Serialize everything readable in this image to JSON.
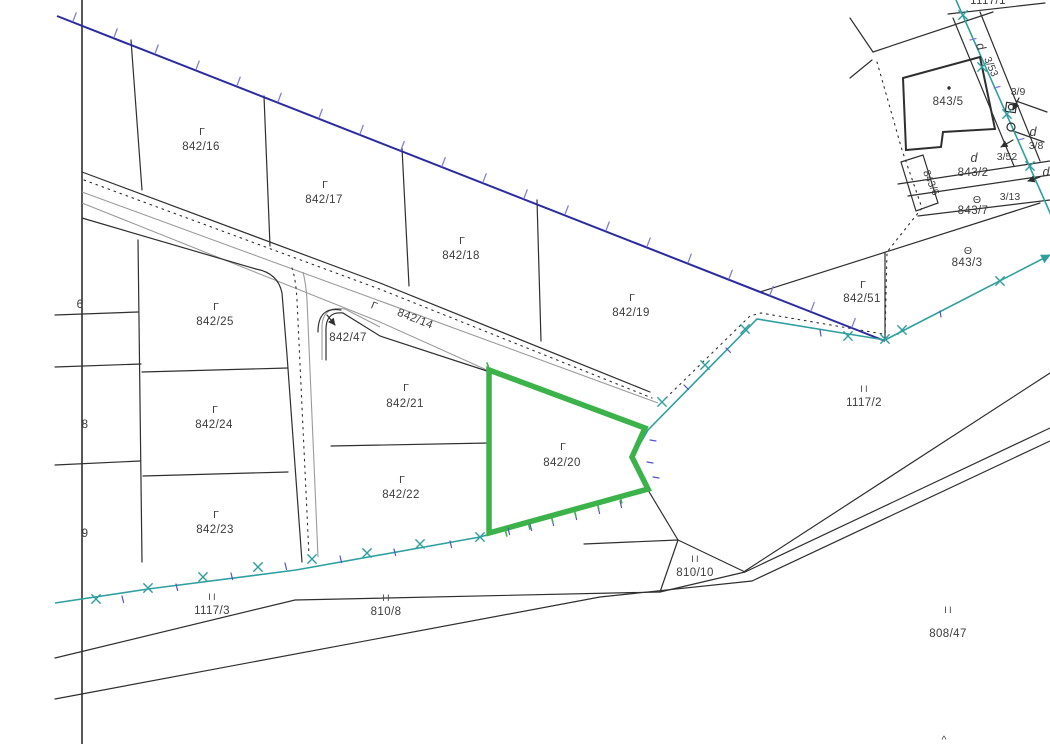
{
  "title": "cadastral-map-view",
  "highlight": {
    "parcel": "842/20",
    "color": "#3cb24b"
  },
  "colors": {
    "blue_boundary": "#2b2ba0",
    "tick_light_blue": "#8080d8",
    "teal_boundary": "#2f9f9f",
    "tick_indigo": "#5252c8",
    "highlight_green": "#3cb24b",
    "line_black": "#2f2f2f",
    "line_gray": "#9a9a9a",
    "label_color": "#3c3c3c"
  },
  "labels": {
    "a842_16": {
      "sym": "Γ",
      "num": "842/16"
    },
    "a842_17": {
      "sym": "Γ",
      "num": "842/17"
    },
    "a842_18": {
      "sym": "Γ",
      "num": "842/18"
    },
    "a842_19": {
      "sym": "Γ",
      "num": "842/19"
    },
    "a842_51": {
      "sym": "Γ",
      "num": "842/51"
    },
    "a842_25": {
      "sym": "Γ",
      "num": "842/25"
    },
    "a842_24": {
      "sym": "Γ",
      "num": "842/24"
    },
    "a842_23": {
      "sym": "Γ",
      "num": "842/23"
    },
    "a842_21": {
      "sym": "Γ",
      "num": "842/21"
    },
    "a842_22": {
      "sym": "Γ",
      "num": "842/22"
    },
    "a842_20": {
      "sym": "Γ",
      "num": "842/20"
    },
    "a842_14": {
      "sym": "Γ",
      "num": "842/14"
    },
    "a842_47": {
      "num": "842/47"
    },
    "a1117_2": {
      "sym": "II",
      "num": "1117/2"
    },
    "a1117_3": {
      "sym": "II",
      "num": "1117/3"
    },
    "a810_8": {
      "sym": "II",
      "num": "810/8"
    },
    "a810_10": {
      "sym": "II",
      "num": "810/10"
    },
    "a808_47": {
      "sym": "II",
      "num": "808/47"
    },
    "a843_5": {
      "num": "843/5"
    },
    "a843_2": {
      "sym": "d",
      "num": "843/2"
    },
    "a843_7": {
      "sym": "Θ",
      "num": "843/7"
    },
    "a843_3": {
      "sym": "Θ",
      "num": "843/3"
    },
    "a843_6": {
      "num": "843/6"
    },
    "a3_53": {
      "sym": "d",
      "num": "3/53"
    },
    "a3_9": {
      "num": "3/9"
    },
    "a3_52": {
      "num": "3/52"
    },
    "a3_8": {
      "sym": "d",
      "num": "3/8"
    },
    "a3_13": {
      "num": "3/13"
    },
    "edge6": {
      "num": "6"
    },
    "edge8": {
      "num": "8"
    },
    "edge9": {
      "num": "9"
    },
    "edge_top": {
      "num": "1117/1"
    },
    "edge_d": {
      "sym": "d"
    },
    "caret": {
      "num": "^"
    }
  }
}
